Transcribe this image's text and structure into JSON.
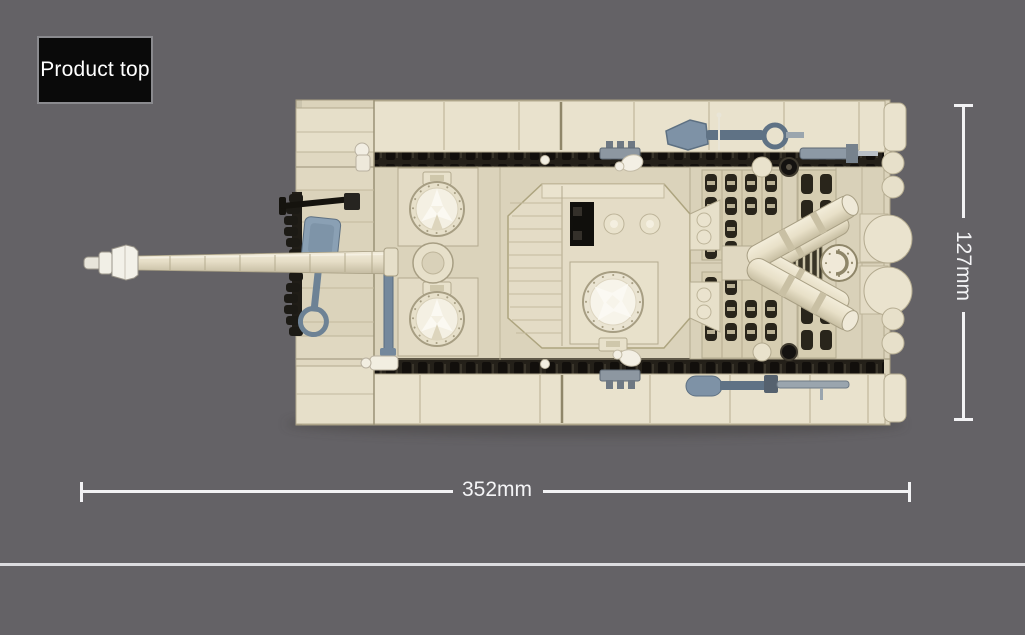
{
  "page": {
    "background_color": "#646266",
    "divider_color": "#dcdcdf"
  },
  "product_label": {
    "text": "Product top",
    "box_background": "#0a0a0a",
    "box_border_color": "#8a8a8e",
    "text_color": "#ffffff"
  },
  "dimensions": {
    "line_color": "#f2f2f4",
    "width_label": "352mm",
    "height_label": "127mm"
  },
  "product_image": {
    "description": "Top view of a tan brick-built toy tank with long gun barrel pointing left, twin round hatches, central cupola, rear engine grilles and V-shaped exhaust pipes",
    "colors": {
      "hull_tan": "#dbd3bb",
      "plate_light": "#e9e2cd",
      "turret_tan": "#e4dcc6",
      "deck_tan": "#d9d1b9",
      "track_dark": "#242019",
      "tool_gray_blue": "#7e92a6",
      "tool_gray": "#8d99a5",
      "detail_white": "#f3efe4",
      "detail_black": "#15130e"
    }
  }
}
